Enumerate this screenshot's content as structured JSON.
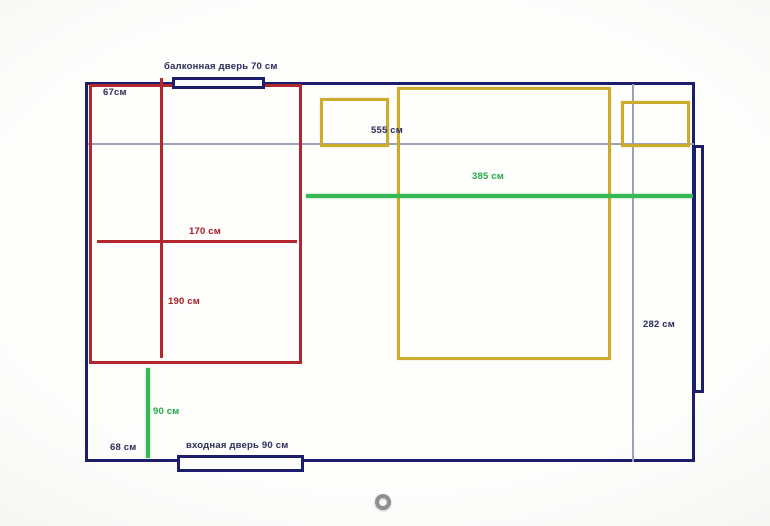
{
  "title": "room floor plan sketch",
  "labels": {
    "balcony_door": "балконная дверь 70 см",
    "entrance_door": "входная дверь 90 см",
    "corner_offset": "67см",
    "wardrobe_row": "555 см",
    "room_width": "385 см",
    "desk_width": "170 см",
    "desk_depth": "190 см",
    "room_depth_right": "282 см",
    "door_clearance": "90 см",
    "left_clearance": "68 см"
  },
  "colors": {
    "wall": "#1d1d6e",
    "red": "#b2262c",
    "yellow": "#ccab2d",
    "green": "#36b854",
    "guide": "#9aa3b5",
    "lblnavy": "#32325e",
    "lblred": "#a8242a",
    "lblgreen": "#2fae4f"
  }
}
